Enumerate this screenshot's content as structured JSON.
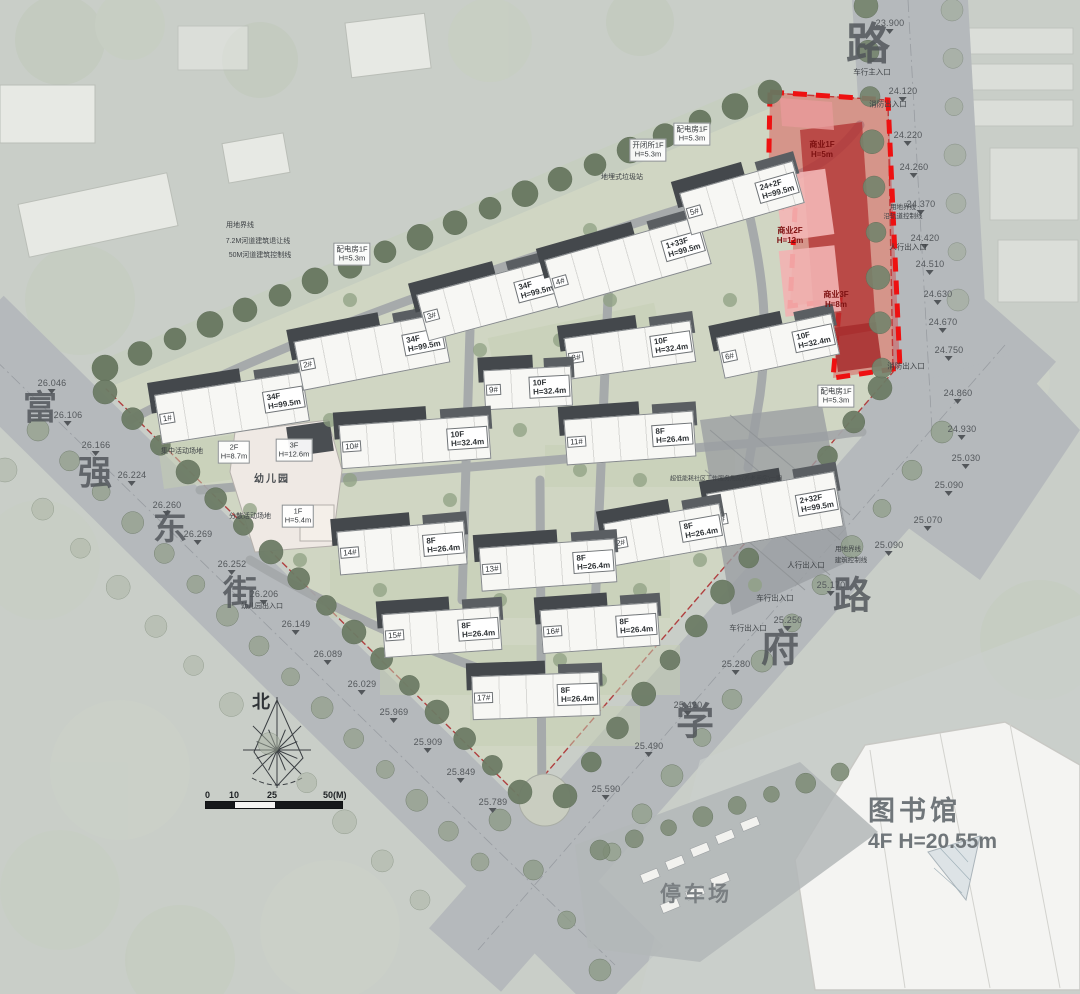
{
  "landmarks": {
    "library_name": "图书馆",
    "library_spec": "4F  H=20.55m",
    "parking": "停车场",
    "north": "北"
  },
  "scale_bar": {
    "ticks": [
      "0",
      "10",
      "25",
      "50(M)"
    ]
  },
  "road_names": {
    "west_street": "富强东街",
    "east_road": "路",
    "southeast_road": "学府路"
  },
  "road_labels": [
    {
      "ch": "路",
      "x": 868,
      "y": 40,
      "s": 44
    },
    {
      "ch": "富",
      "x": 40,
      "y": 405,
      "s": 34
    },
    {
      "ch": "强",
      "x": 95,
      "y": 470,
      "s": 34
    },
    {
      "ch": "东",
      "x": 170,
      "y": 525,
      "s": 34
    },
    {
      "ch": "街",
      "x": 240,
      "y": 590,
      "s": 34
    },
    {
      "ch": "路",
      "x": 852,
      "y": 592,
      "s": 38
    },
    {
      "ch": "府",
      "x": 780,
      "y": 645,
      "s": 38
    },
    {
      "ch": "学",
      "x": 695,
      "y": 718,
      "s": 38
    }
  ],
  "buildings": [
    {
      "id": "1#",
      "spec": "34F\nH=99.5m",
      "x": 232,
      "y": 408,
      "w": 150,
      "h": 50,
      "r": -9
    },
    {
      "id": "2#",
      "spec": "34F\nH=99.5m",
      "x": 372,
      "y": 352,
      "w": 150,
      "h": 50,
      "r": -11
    },
    {
      "id": "3#",
      "spec": "34F\nH=99.5m",
      "x": 490,
      "y": 300,
      "w": 140,
      "h": 48,
      "r": -15
    },
    {
      "id": "4#",
      "spec": "1+33F\nH=99.5m",
      "x": 628,
      "y": 262,
      "w": 160,
      "h": 50,
      "r": -16
    },
    {
      "id": "5#",
      "spec": "24+2F\nH=99.5m",
      "x": 742,
      "y": 198,
      "w": 118,
      "h": 44,
      "r": -16
    },
    {
      "id": "6#",
      "spec": "10F\nH=32.4m",
      "x": 778,
      "y": 346,
      "w": 118,
      "h": 42,
      "r": -12
    },
    {
      "id": "7#",
      "spec": "2+32F\nH=99.5m",
      "x": 775,
      "y": 510,
      "w": 130,
      "h": 56,
      "r": -10
    },
    {
      "id": "8#",
      "spec": "10F\nH=32.4m",
      "x": 630,
      "y": 350,
      "w": 128,
      "h": 42,
      "r": -8
    },
    {
      "id": "9#",
      "spec": "10F\nH=32.4m",
      "x": 528,
      "y": 388,
      "w": 88,
      "h": 40,
      "r": -3
    },
    {
      "id": "10#",
      "spec": "10F\nH=32.4m",
      "x": 415,
      "y": 442,
      "w": 150,
      "h": 44,
      "r": -4
    },
    {
      "id": "11#",
      "spec": "8F\nH=26.4m",
      "x": 630,
      "y": 438,
      "w": 130,
      "h": 46,
      "r": -4
    },
    {
      "id": "12#",
      "spec": "8F\nH=26.4m",
      "x": 665,
      "y": 535,
      "w": 118,
      "h": 44,
      "r": -10
    },
    {
      "id": "13#",
      "spec": "8F\nH=26.4m",
      "x": 548,
      "y": 565,
      "w": 136,
      "h": 44,
      "r": -4
    },
    {
      "id": "14#",
      "spec": "8F\nH=26.4m",
      "x": 402,
      "y": 548,
      "w": 128,
      "h": 44,
      "r": -5
    },
    {
      "id": "15#",
      "spec": "8F\nH=26.4m",
      "x": 442,
      "y": 632,
      "w": 118,
      "h": 44,
      "r": -4
    },
    {
      "id": "16#",
      "spec": "8F\nH=26.4m",
      "x": 600,
      "y": 628,
      "w": 118,
      "h": 44,
      "r": -4
    },
    {
      "id": "17#",
      "spec": "8F\nH=26.4m",
      "x": 536,
      "y": 696,
      "w": 128,
      "h": 44,
      "r": -2
    }
  ],
  "facility_labels": [
    {
      "t": "配电房1F\nH=5.3m",
      "x": 352,
      "y": 254
    },
    {
      "t": "开闭所1F\nH=5.3m",
      "x": 648,
      "y": 150
    },
    {
      "t": "配电房1F\nH=5.3m",
      "x": 692,
      "y": 134
    },
    {
      "t": "配电房1F\nH=5.3m",
      "x": 836,
      "y": 396
    },
    {
      "t": "2F\nH=8.7m",
      "x": 234,
      "y": 452
    },
    {
      "t": "3F\nH=12.6m",
      "x": 294,
      "y": 450
    },
    {
      "t": "1F\nH=5.4m",
      "x": 298,
      "y": 516
    },
    {
      "t": "幼儿园",
      "x": 272,
      "y": 480,
      "plain": 1
    }
  ],
  "commercial_labels": [
    {
      "t": "商业1F\nH=5m",
      "x": 822,
      "y": 150
    },
    {
      "t": "商业2F\nH=12m",
      "x": 790,
      "y": 236
    },
    {
      "t": "商业3F\nH=8m",
      "x": 836,
      "y": 300
    }
  ],
  "elevations": [
    {
      "v": "26.046",
      "x": 52,
      "y": 378
    },
    {
      "v": "26.106",
      "x": 68,
      "y": 410
    },
    {
      "v": "26.166",
      "x": 96,
      "y": 440
    },
    {
      "v": "26.224",
      "x": 132,
      "y": 470
    },
    {
      "v": "26.260",
      "x": 167,
      "y": 500
    },
    {
      "v": "26.269",
      "x": 198,
      "y": 529
    },
    {
      "v": "26.252",
      "x": 232,
      "y": 559
    },
    {
      "v": "26.206",
      "x": 264,
      "y": 589
    },
    {
      "v": "26.149",
      "x": 296,
      "y": 619
    },
    {
      "v": "26.089",
      "x": 328,
      "y": 649
    },
    {
      "v": "26.029",
      "x": 362,
      "y": 679
    },
    {
      "v": "25.969",
      "x": 394,
      "y": 707
    },
    {
      "v": "25.909",
      "x": 428,
      "y": 737
    },
    {
      "v": "25.849",
      "x": 461,
      "y": 767
    },
    {
      "v": "25.789",
      "x": 493,
      "y": 797
    },
    {
      "v": "23.900",
      "x": 890,
      "y": 18
    },
    {
      "v": "24.120",
      "x": 903,
      "y": 86
    },
    {
      "v": "24.220",
      "x": 908,
      "y": 130
    },
    {
      "v": "24.260",
      "x": 914,
      "y": 162
    },
    {
      "v": "24.370",
      "x": 921,
      "y": 199
    },
    {
      "v": "24.420",
      "x": 925,
      "y": 233
    },
    {
      "v": "24.510",
      "x": 930,
      "y": 259
    },
    {
      "v": "24.630",
      "x": 938,
      "y": 289
    },
    {
      "v": "24.670",
      "x": 943,
      "y": 317
    },
    {
      "v": "24.750",
      "x": 949,
      "y": 345
    },
    {
      "v": "24.860",
      "x": 958,
      "y": 388
    },
    {
      "v": "24.930",
      "x": 962,
      "y": 424
    },
    {
      "v": "25.030",
      "x": 966,
      "y": 453
    },
    {
      "v": "25.090",
      "x": 949,
      "y": 480
    },
    {
      "v": "25.070",
      "x": 928,
      "y": 515
    },
    {
      "v": "25.090",
      "x": 889,
      "y": 540
    },
    {
      "v": "25.170",
      "x": 831,
      "y": 580
    },
    {
      "v": "25.250",
      "x": 788,
      "y": 615
    },
    {
      "v": "25.280",
      "x": 736,
      "y": 659
    },
    {
      "v": "25.420",
      "x": 688,
      "y": 700
    },
    {
      "v": "25.490",
      "x": 649,
      "y": 741
    },
    {
      "v": "25.590",
      "x": 606,
      "y": 784
    }
  ],
  "annotations": [
    {
      "t": "车行主入口",
      "x": 872,
      "y": 72
    },
    {
      "t": "消防出入口",
      "x": 888,
      "y": 104
    },
    {
      "t": "用地界线",
      "x": 903,
      "y": 206,
      "s": 6.5
    },
    {
      "t": "沿轨道控制线",
      "x": 903,
      "y": 215,
      "s": 6.5
    },
    {
      "t": "人行出入口",
      "x": 908,
      "y": 247
    },
    {
      "t": "消防出入口",
      "x": 906,
      "y": 366
    },
    {
      "t": "用地界线",
      "x": 848,
      "y": 548,
      "s": 6.5
    },
    {
      "t": "建筑控制线",
      "x": 851,
      "y": 559,
      "s": 6.5
    },
    {
      "t": "人行出入口",
      "x": 806,
      "y": 565
    },
    {
      "t": "车行出入口",
      "x": 775,
      "y": 598
    },
    {
      "t": "车行出入口",
      "x": 748,
      "y": 628
    },
    {
      "t": "用地界线",
      "x": 240,
      "y": 225,
      "s": 7
    },
    {
      "t": "7.2M河道建筑退让线",
      "x": 258,
      "y": 241,
      "s": 7
    },
    {
      "t": "50M河道建筑控制线",
      "x": 260,
      "y": 255,
      "s": 7
    },
    {
      "t": "地埋式垃圾站",
      "x": 622,
      "y": 177,
      "s": 7
    },
    {
      "t": "集中活动场地",
      "x": 182,
      "y": 451,
      "s": 7
    },
    {
      "t": "分散活动场地",
      "x": 250,
      "y": 516,
      "s": 7
    },
    {
      "t": "幼儿园出入口",
      "x": 262,
      "y": 606,
      "s": 7
    },
    {
      "t": "超低能耗社区工作服务用房(养老用房)一期",
      "x": 726,
      "y": 478,
      "s": 6
    }
  ]
}
